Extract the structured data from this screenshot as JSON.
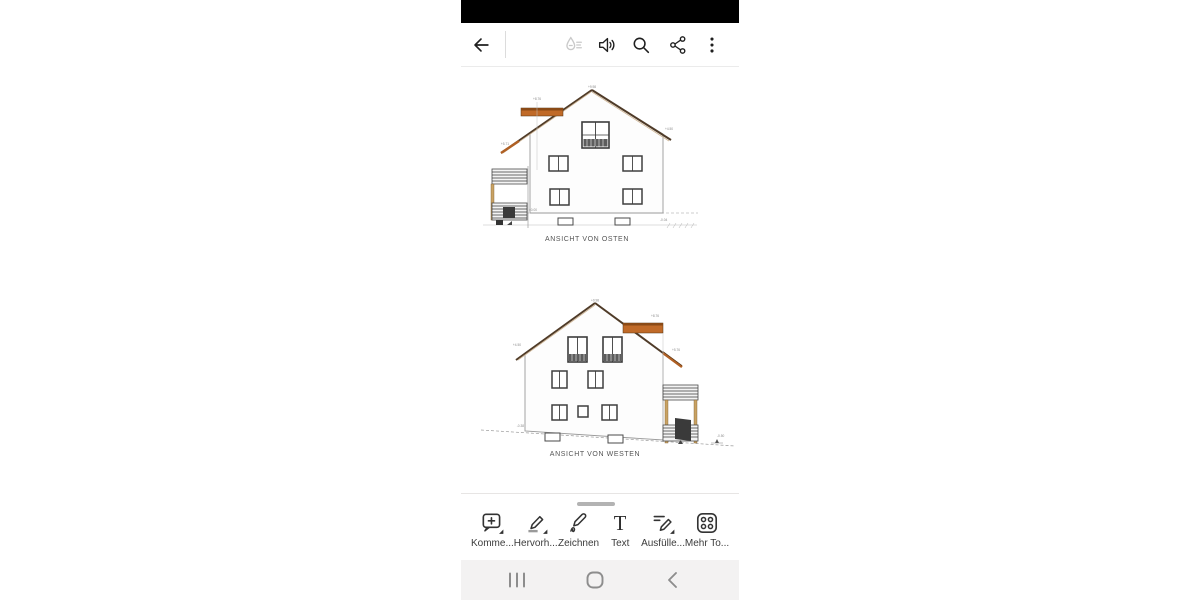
{
  "toolbar_top": {
    "icons": [
      "back-arrow",
      "liquid-mode",
      "read-aloud-speaker",
      "search",
      "share",
      "more-options"
    ]
  },
  "document": {
    "views": [
      {
        "caption": "ANSICHT VON OSTEN",
        "labels": {
          "peak": "+9.98",
          "upper_left": "+8.76",
          "eave_left": "+5.71",
          "eave_right": "+4.50",
          "ground": "±0.00",
          "base_right": "-0.04"
        }
      },
      {
        "caption": "ANSICHT VON WESTEN",
        "labels": {
          "peak": "+9.98",
          "eave_left": "+4.50",
          "upper_right": "+8.76",
          "eave_right": "+5.76",
          "base_left": "-0.38",
          "base_right": "-0.50"
        }
      }
    ]
  },
  "tools_sheet": {
    "tools": [
      {
        "id": "comment",
        "label": "Komme..."
      },
      {
        "id": "highlight",
        "label": "Hervorh..."
      },
      {
        "id": "draw",
        "label": "Zeichnen"
      },
      {
        "id": "text",
        "label": "Text",
        "icon_glyph": "T"
      },
      {
        "id": "fill-sign",
        "label": "Ausfülle..."
      },
      {
        "id": "more-tools",
        "label": "Mehr To..."
      }
    ]
  },
  "nav_bar": {
    "icons": [
      "recents",
      "home",
      "back"
    ]
  },
  "colors": {
    "status_bar": "#000000",
    "roof_accent": "#c06a28",
    "nav_bg": "#f3f2f2"
  }
}
